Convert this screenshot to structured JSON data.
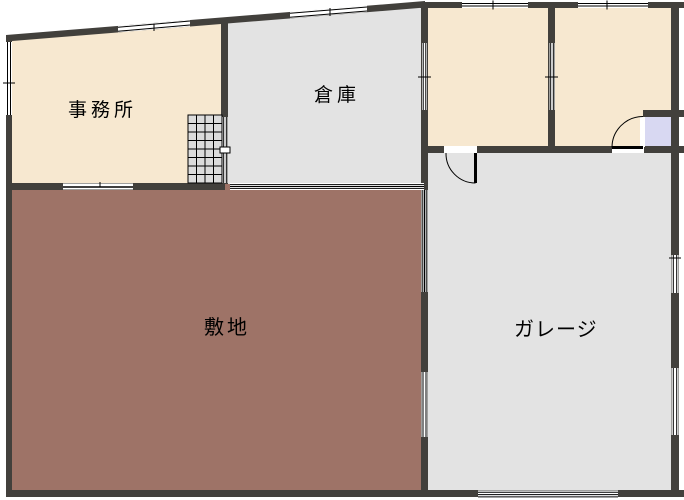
{
  "title": "floor-plan",
  "labels": {
    "office": "事務所",
    "warehouse": "倉庫",
    "site": "敷地",
    "garage": "ガレージ"
  },
  "colors": {
    "wall": "#42403C",
    "room_cream": "#F7E8D0",
    "room_gray": "#E3E3E3",
    "site_brown": "#9E7367",
    "entry_lavender": "#D8D8F2",
    "stairs_gray": "#DCDCDC",
    "line": "#000000",
    "background": "#FFFFFF"
  }
}
